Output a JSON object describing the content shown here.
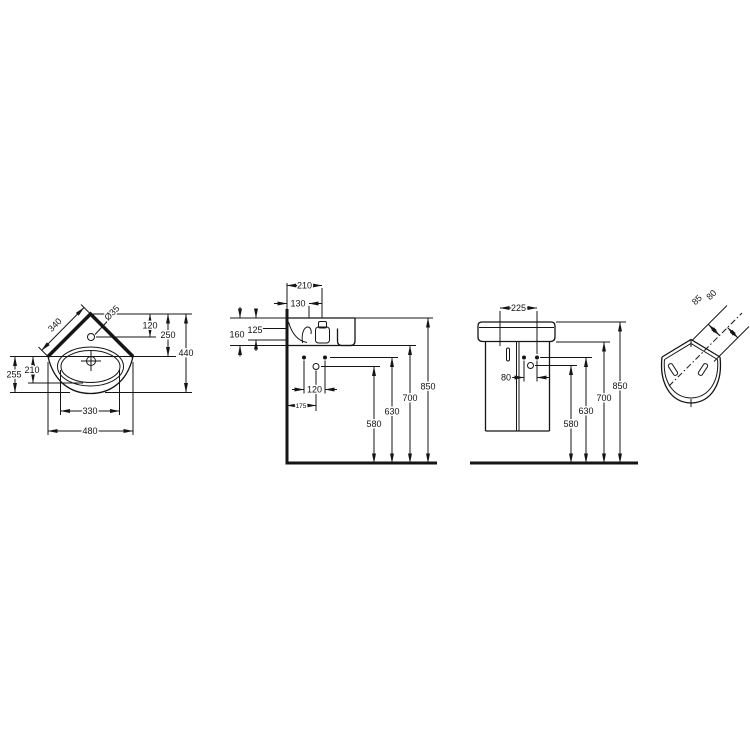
{
  "drawing": {
    "kind": "corner-washbasin-technical-dimension-drawing",
    "background_color": "#ffffff",
    "line_color": "#151515"
  },
  "views": {
    "plan": {
      "label": "plan-view",
      "dims": {
        "tap_hole_diameter": "Ø35",
        "back_edge": "340",
        "tap_depth": "120",
        "corner_to_rim": "250",
        "total_depth": "440",
        "left_outer": "255",
        "left_inner": "210",
        "bowl_width": "330",
        "total_width": "480"
      }
    },
    "side": {
      "label": "side-section-view",
      "dims": {
        "wall_to_tap": "210",
        "wall_to_fixing": "130",
        "rim_to_underside": "160",
        "rim_to_fixing": "125",
        "fixing_pitch": "120",
        "wall_to_trap": "175",
        "trap_height": "580",
        "fixing_height": "630",
        "underside_height": "700",
        "rim_height": "850"
      }
    },
    "front": {
      "label": "front-elevation-view",
      "dims": {
        "fixing_span": "225",
        "hole_pitch": "80",
        "trap_height": "580",
        "fixing_height": "630",
        "underside_height": "700",
        "rim_height": "850"
      }
    },
    "corner": {
      "label": "corner-installation-view",
      "dims": {
        "offset_a": "85",
        "offset_b": "80"
      }
    }
  }
}
